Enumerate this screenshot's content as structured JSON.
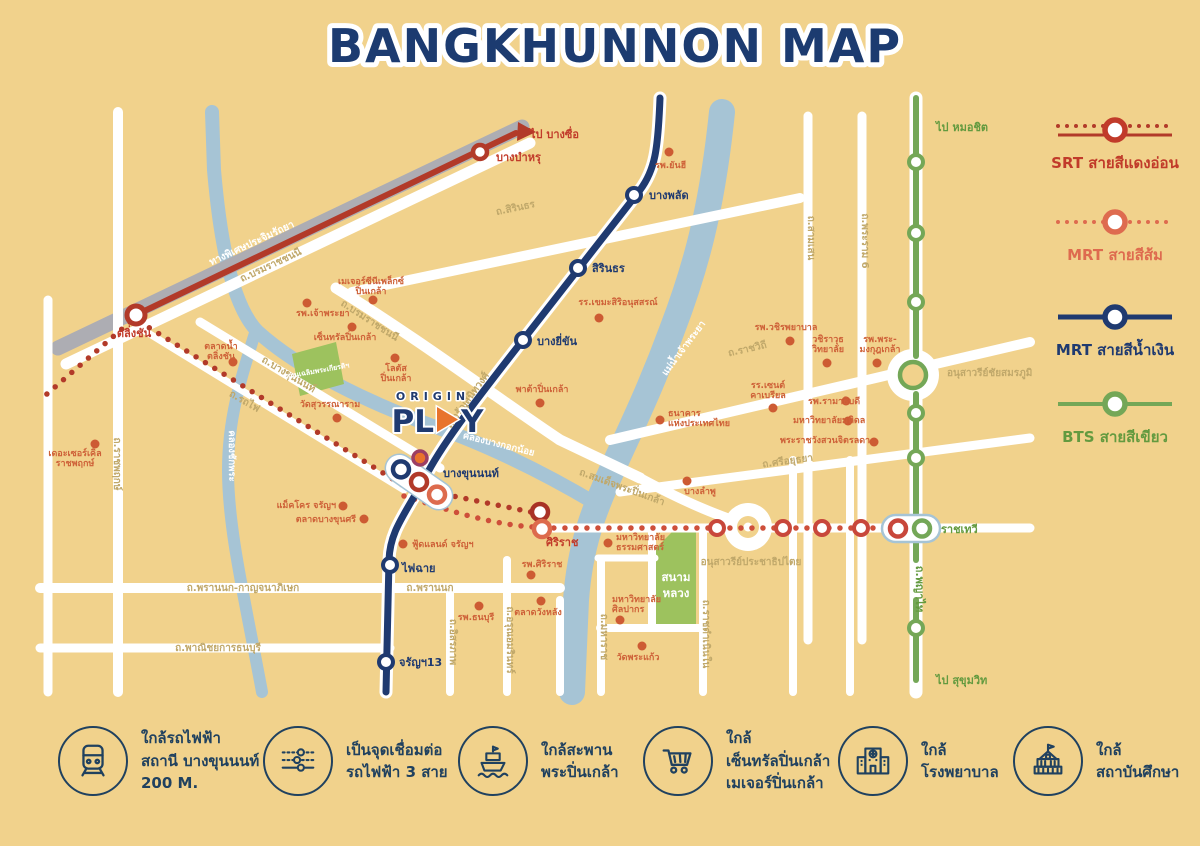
{
  "title": "BANGKHUNNON MAP",
  "logo": {
    "origin": "ORIGIN",
    "pl": "PL",
    "y": "Y"
  },
  "legend": {
    "items": [
      {
        "label": "SRT สายสีแดงอ่อน",
        "color": "#B23A29",
        "style": "dotted-solid"
      },
      {
        "label": "MRT สายสีส้ม",
        "color": "#DE6B4F",
        "style": "dotted"
      },
      {
        "label": "MRT สายสีน้ำเงิน",
        "color": "#1F3A70",
        "style": "solid"
      },
      {
        "label": "BTS สายสีเขียว",
        "color": "#74A757",
        "style": "solid"
      }
    ]
  },
  "features": [
    {
      "icon": "train-icon",
      "line1": "ใกล้รถไฟฟ้า",
      "line2": "สถานี บางขุนนนท์",
      "line3": "200 M."
    },
    {
      "icon": "transit-lines-icon",
      "line1": "เป็นจุดเชื่อมต่อ",
      "line2": "รถไฟฟ้า 3 สาย",
      "line3": ""
    },
    {
      "icon": "boat-icon",
      "line1": "ใกล้สะพาน",
      "line2": "พระปิ่นเกล้า",
      "line3": ""
    },
    {
      "icon": "cart-icon",
      "line1": "ใกล้",
      "line2": "เซ็นทรัลปิ่นเกล้า",
      "line3": "เมเจอร์ปิ่นเกล้า"
    },
    {
      "icon": "hospital-icon",
      "line1": "ใกล้",
      "line2": "โรงพยาบาล",
      "line3": ""
    },
    {
      "icon": "school-icon",
      "line1": "ใกล้",
      "line2": "สถาบันศึกษา",
      "line3": ""
    }
  ],
  "colors": {
    "background": "#F1D28C",
    "road": "#FFFFFF",
    "water": "#A6C4D5",
    "expressway": "#ADADB3",
    "srt_red": "#B23A29",
    "mrt_orange": "#DE6B4F",
    "mrt_blue": "#1F3A70",
    "bts_green": "#74A757",
    "park": "#9DC25E",
    "poi": "#CD5B33",
    "road_label": "#C0A86A",
    "feature_ink": "#20415F",
    "title_ink": "#1C3B70"
  },
  "map": {
    "labels": [
      {
        "t": "ทางพิเศษประจิมรัถยา",
        "x": 253,
        "y": 246,
        "r": -25,
        "c": "white",
        "s": 11
      },
      {
        "t": "ถ.บรมราชชนนี",
        "x": 272,
        "y": 268,
        "r": -25,
        "c": "road"
      },
      {
        "t": "ถ.บรมราชชนนี",
        "x": 368,
        "y": 323,
        "r": 33,
        "c": "road"
      },
      {
        "t": "ถ.สิรินธร",
        "x": 516,
        "y": 211,
        "r": -12,
        "c": "road"
      },
      {
        "t": "ถ.จรัญสนิทวงศ์",
        "x": 470,
        "y": 402,
        "r": -54,
        "c": "road"
      },
      {
        "t": "ถ.บางขุนนนท์",
        "x": 287,
        "y": 377,
        "r": 31,
        "c": "road"
      },
      {
        "t": "ถ.รถไฟ",
        "x": 243,
        "y": 404,
        "r": 30,
        "c": "road"
      },
      {
        "t": "ถ.ราชพฤกษ์",
        "x": 114,
        "y": 464,
        "r": 90,
        "c": "road"
      },
      {
        "t": "ถ.พรานนก-กาญจนาภิเษก",
        "x": 243,
        "y": 591,
        "c": "road"
      },
      {
        "t": "ถ.พรานนก",
        "x": 430,
        "y": 591,
        "c": "road"
      },
      {
        "t": "ถ.พาณิชยการธนบุรี",
        "x": 218,
        "y": 651,
        "c": "road"
      },
      {
        "t": "ถ.อิสรภาพ",
        "x": 450,
        "y": 642,
        "r": 90,
        "c": "road"
      },
      {
        "t": "ถ.อรุณอมรินทร์",
        "x": 507,
        "y": 640,
        "r": 90,
        "c": "road"
      },
      {
        "t": "ถ.มหาราช",
        "x": 601,
        "y": 637,
        "r": 90,
        "c": "road"
      },
      {
        "t": "ถ.ราชดำเนินใน",
        "x": 703,
        "y": 634,
        "r": 90,
        "c": "road"
      },
      {
        "t": "ถ.สมเด็จพระปิ่นเกล้า",
        "x": 621,
        "y": 490,
        "r": 20,
        "c": "road"
      },
      {
        "t": "ถ.ราชวิถี",
        "x": 748,
        "y": 352,
        "r": -13,
        "c": "road"
      },
      {
        "t": "ถ.ศรีอยุธยา",
        "x": 788,
        "y": 464,
        "r": -8,
        "c": "road"
      },
      {
        "t": "ถ.สามเสน",
        "x": 808,
        "y": 238,
        "r": 90,
        "c": "road"
      },
      {
        "t": "ถ.พระราม 6",
        "x": 862,
        "y": 241,
        "r": 90,
        "c": "road"
      },
      {
        "t": "ถ.พญาไท",
        "x": 916,
        "y": 589,
        "r": 90,
        "c": "green",
        "s": 10
      },
      {
        "t": "อนุสาวรีย์ชัยสมรภูมิ",
        "x": 947,
        "y": 376,
        "a": "start",
        "c": "road"
      },
      {
        "t": "อนุสาวรีย์ประชาธิปไตย",
        "x": 751,
        "y": 565,
        "c": "road"
      },
      {
        "t": "แม่น้ำเจ้าพระยา",
        "x": 686,
        "y": 350,
        "r": -53,
        "c": "water"
      },
      {
        "t": "คลองบางกอกน้อย",
        "x": 498,
        "y": 447,
        "r": 14,
        "c": "water"
      },
      {
        "t": "คลองชักพระ",
        "x": 229,
        "y": 456,
        "r": 90,
        "c": "water"
      },
      {
        "t": "สวนเฉลิมพระเกียรติฯ",
        "x": 318,
        "y": 373,
        "r": -10,
        "c": "park"
      },
      {
        "t": "สนาม",
        "x": 676,
        "y": 581,
        "c": "parkbig"
      },
      {
        "t": "หลวง",
        "x": 676,
        "y": 597,
        "c": "parkbig"
      },
      {
        "t": "ไป บางซื่อ",
        "x": 530,
        "y": 138,
        "a": "start",
        "c": "red"
      },
      {
        "t": "บางบำหรุ",
        "x": 496,
        "y": 161,
        "a": "start",
        "c": "red"
      },
      {
        "t": "ตลิ่งชัน",
        "x": 134,
        "y": 337,
        "c": "red"
      },
      {
        "t": "ศิริราช",
        "x": 546,
        "y": 546,
        "a": "start",
        "c": "red"
      },
      {
        "t": "บางพลัด",
        "x": 649,
        "y": 199,
        "a": "start",
        "c": "navy"
      },
      {
        "t": "สิรินธร",
        "x": 592,
        "y": 272,
        "a": "start",
        "c": "navy"
      },
      {
        "t": "บางยี่ขัน",
        "x": 537,
        "y": 345,
        "a": "start",
        "c": "navy"
      },
      {
        "t": "บางขุนนนท์",
        "x": 443,
        "y": 477,
        "a": "start",
        "c": "navy"
      },
      {
        "t": "ไฟฉาย",
        "x": 402,
        "y": 572,
        "a": "start",
        "c": "navy"
      },
      {
        "t": "จรัญฯ13",
        "x": 399,
        "y": 666,
        "a": "start",
        "c": "navy"
      },
      {
        "t": "ราชเทวี",
        "x": 941,
        "y": 533,
        "a": "start",
        "c": "green"
      },
      {
        "t": "ไป หมอชิต",
        "x": 936,
        "y": 131,
        "a": "start",
        "c": "green"
      },
      {
        "t": "ไป สุขุมวิท",
        "x": 936,
        "y": 684,
        "a": "start",
        "c": "green"
      },
      {
        "t": "รพ.ยันฮี",
        "x": 655,
        "y": 168,
        "a": "start",
        "c": "poi"
      },
      {
        "t": "รพ.เจ้าพระยา",
        "x": 296,
        "y": 316,
        "a": "start",
        "c": "poi"
      },
      {
        "t": "เมเจอร์ซีนีเพล็กซ์",
        "x": 371,
        "y": 284,
        "c": "poi"
      },
      {
        "t": "ปิ่นเกล้า",
        "x": 371,
        "y": 294,
        "c": "poi"
      },
      {
        "t": "เซ็นทรัลปิ่นเกล้า",
        "x": 345,
        "y": 340,
        "c": "poi"
      },
      {
        "t": "โลตัส",
        "x": 396,
        "y": 371,
        "c": "poi"
      },
      {
        "t": "ปิ่นเกล้า",
        "x": 396,
        "y": 381,
        "c": "poi"
      },
      {
        "t": "ตลาดน้ำ",
        "x": 221,
        "y": 349,
        "c": "poi"
      },
      {
        "t": "ตลิ่งชัน",
        "x": 221,
        "y": 359,
        "c": "poi"
      },
      {
        "t": "วัดสุวรรณาราม",
        "x": 330,
        "y": 407,
        "c": "poi"
      },
      {
        "t": "เดอะเซอร์เคิล",
        "x": 75,
        "y": 456,
        "c": "poi"
      },
      {
        "t": "ราชพฤกษ์",
        "x": 75,
        "y": 466,
        "c": "poi"
      },
      {
        "t": "แม็คโคร จรัญฯ",
        "x": 336,
        "y": 508,
        "a": "end",
        "c": "poi"
      },
      {
        "t": "ตลาดบางขุนศรี",
        "x": 356,
        "y": 522,
        "a": "end",
        "c": "poi"
      },
      {
        "t": "ฟู้ดแลนด์ จรัญฯ",
        "x": 412,
        "y": 547,
        "a": "start",
        "c": "poi"
      },
      {
        "t": "รพ.ศิริราช",
        "x": 542,
        "y": 567,
        "c": "poi"
      },
      {
        "t": "ตลาดวังหลัง",
        "x": 538,
        "y": 615,
        "c": "poi"
      },
      {
        "t": "รพ.ธนบุรี",
        "x": 476,
        "y": 620,
        "c": "poi"
      },
      {
        "t": "มหาวิทยาลัย",
        "x": 616,
        "y": 540,
        "a": "start",
        "c": "poi"
      },
      {
        "t": "ธรรมศาสตร์",
        "x": 616,
        "y": 550,
        "a": "start",
        "c": "poi"
      },
      {
        "t": "มหาวิทยาลัย",
        "x": 612,
        "y": 602,
        "a": "start",
        "c": "poi"
      },
      {
        "t": "ศิลปากร",
        "x": 612,
        "y": 612,
        "a": "start",
        "c": "poi"
      },
      {
        "t": "วัดพระแก้ว",
        "x": 638,
        "y": 660,
        "c": "poi"
      },
      {
        "t": "บางลำพู",
        "x": 700,
        "y": 494,
        "c": "poi"
      },
      {
        "t": "ธนาคาร",
        "x": 668,
        "y": 416,
        "a": "start",
        "c": "poi"
      },
      {
        "t": "แห่งประเทศไทย",
        "x": 668,
        "y": 426,
        "a": "start",
        "c": "poi"
      },
      {
        "t": "พาต้าปิ่นเกล้า",
        "x": 542,
        "y": 392,
        "c": "poi"
      },
      {
        "t": "รพ.วชิรพยาบาล",
        "x": 786,
        "y": 330,
        "c": "poi"
      },
      {
        "t": "วชิราวุธ",
        "x": 828,
        "y": 342,
        "c": "poi"
      },
      {
        "t": "วิทยาลัย",
        "x": 828,
        "y": 352,
        "c": "poi"
      },
      {
        "t": "รพ.พระ-",
        "x": 880,
        "y": 342,
        "c": "poi"
      },
      {
        "t": "มงกุฎเกล้า",
        "x": 880,
        "y": 352,
        "c": "poi"
      },
      {
        "t": "รร.เซนต์",
        "x": 768,
        "y": 388,
        "c": "poi"
      },
      {
        "t": "คาเบรียล",
        "x": 768,
        "y": 398,
        "c": "poi"
      },
      {
        "t": "รพ.รามาธิบดี",
        "x": 808,
        "y": 404,
        "a": "start",
        "c": "poi"
      },
      {
        "t": "มหาวิทยาลัยมหิดล",
        "x": 793,
        "y": 423,
        "a": "start",
        "c": "poi"
      },
      {
        "t": "พระราชวังสวนจิตรลดา",
        "x": 780,
        "y": 443,
        "a": "start",
        "c": "poi"
      },
      {
        "t": "รร.เขมะสิริอนุสสรณ์",
        "x": 618,
        "y": 305,
        "c": "poi"
      }
    ],
    "dots": [
      [
        669,
        152
      ],
      [
        307,
        303
      ],
      [
        373,
        300
      ],
      [
        352,
        327
      ],
      [
        395,
        358
      ],
      [
        233,
        362
      ],
      [
        337,
        418
      ],
      [
        95,
        444
      ],
      [
        403,
        544
      ],
      [
        531,
        575
      ],
      [
        541,
        601
      ],
      [
        479,
        606
      ],
      [
        608,
        543
      ],
      [
        620,
        620
      ],
      [
        642,
        646
      ],
      [
        687,
        481
      ],
      [
        660,
        420
      ],
      [
        540,
        403
      ],
      [
        790,
        341
      ],
      [
        827,
        363
      ],
      [
        877,
        363
      ],
      [
        773,
        408
      ],
      [
        846,
        401
      ],
      [
        848,
        421
      ],
      [
        874,
        442
      ],
      [
        599,
        318
      ],
      [
        343,
        506
      ],
      [
        364,
        519
      ]
    ]
  }
}
